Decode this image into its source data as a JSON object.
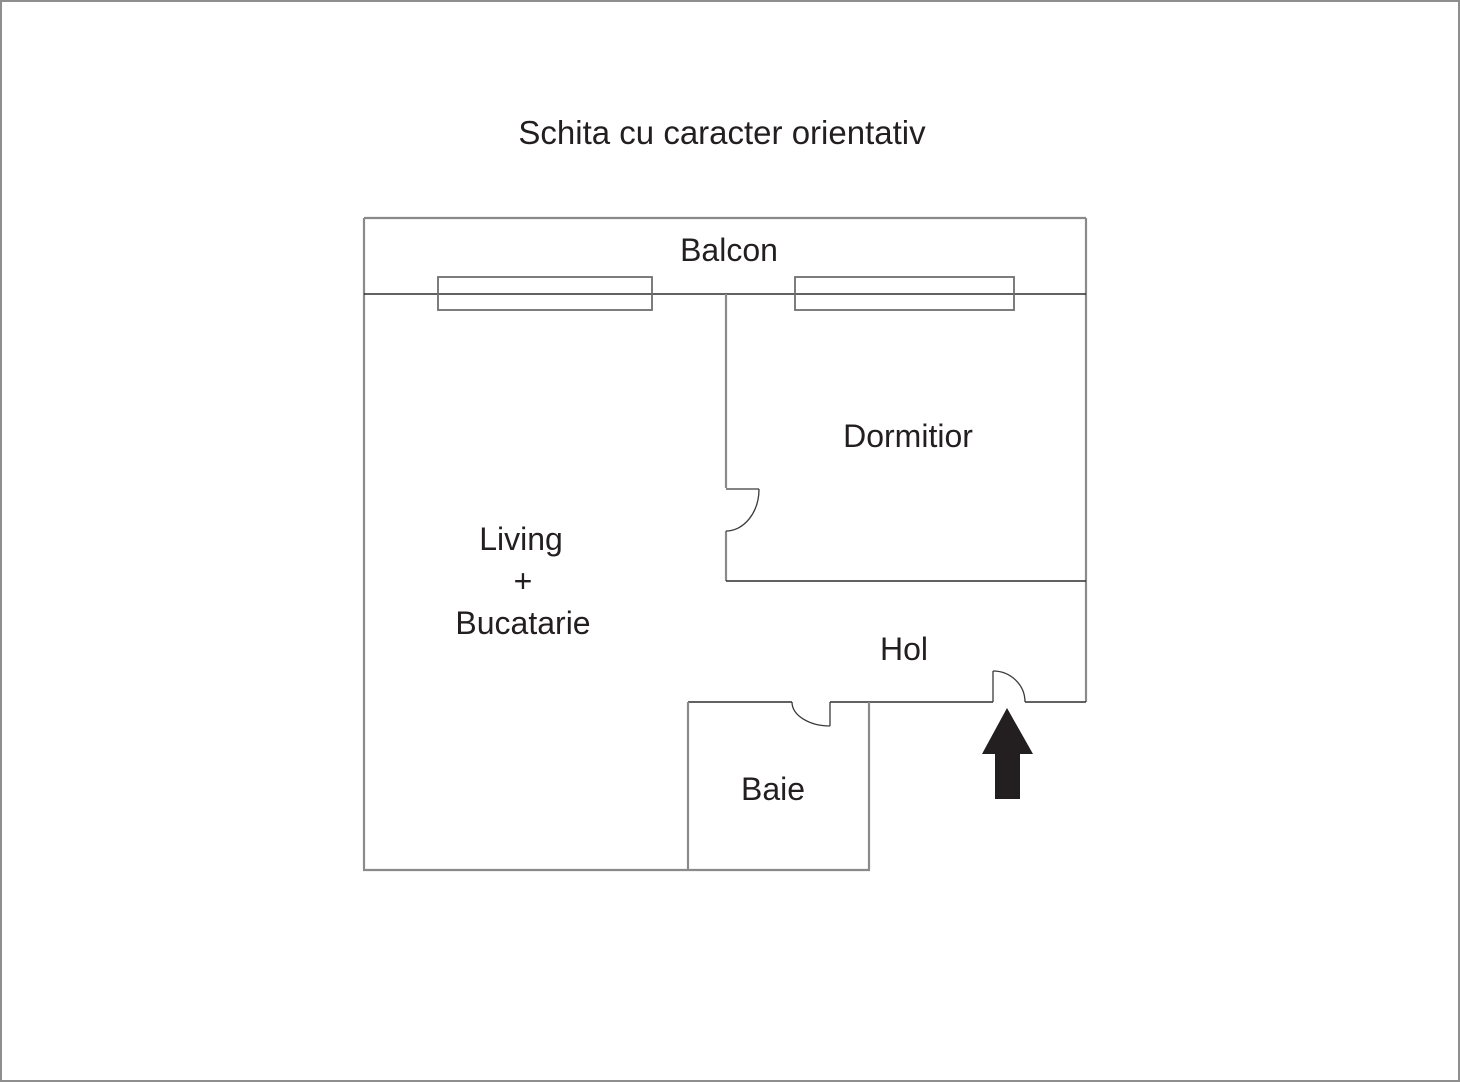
{
  "title": "Schita cu caracter orientativ",
  "rooms": {
    "balcon": {
      "label": "Balcon"
    },
    "dormitor": {
      "label": "Dormitior"
    },
    "living": {
      "label_line1": "Living",
      "label_line2": "+",
      "label_line3": "Bucatarie"
    },
    "hol": {
      "label": "Hol"
    },
    "baie": {
      "label": "Baie"
    }
  },
  "icons": {
    "entrance_arrow": "filled-up-arrow"
  },
  "colors": {
    "background": "#ffffff",
    "outer_border": "#8e8e8e",
    "wall_gray": "#8a8a8a",
    "wall_dark": "#2e2e2e",
    "window_stroke": "#6f6f6f",
    "arrow_fill": "#231f20",
    "text": "#231f20"
  }
}
